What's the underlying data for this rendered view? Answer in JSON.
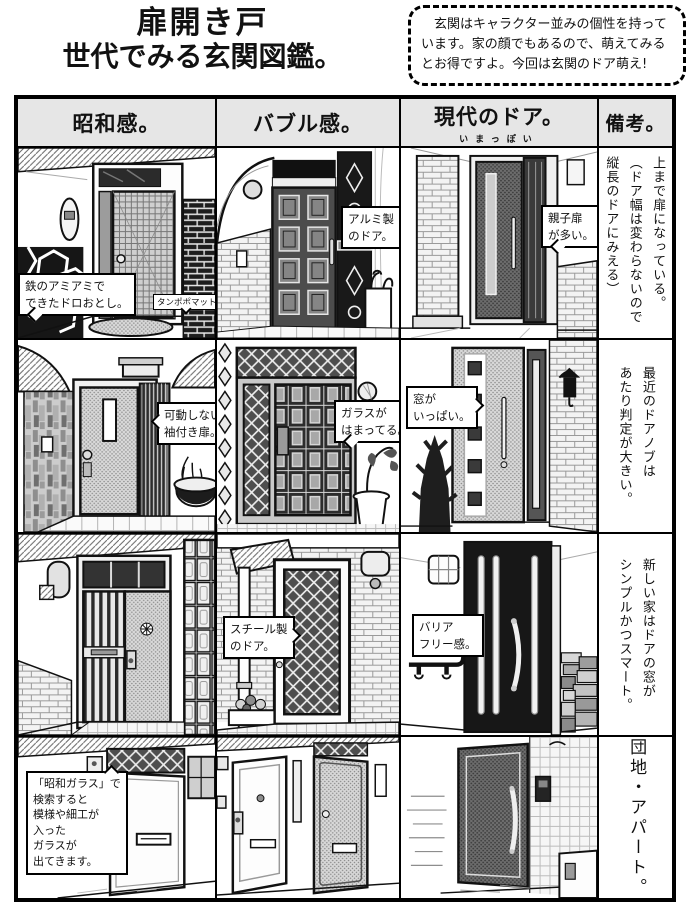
{
  "page": {
    "title_line1": "扉開き戸",
    "title_line2": "世代でみる玄関図鑑。",
    "intro": "　玄関はキャラクター並みの個性を持っています。家の顔でもあるので、萌えてみるとお得ですよ。今回は玄関のドア萌え!"
  },
  "table": {
    "headers": {
      "showa": "昭和感。",
      "bubble": "バブル感。",
      "modern": "現代のドア。",
      "modern_furigana": "いまっぽい",
      "note": "備考。"
    },
    "rows": [
      {
        "showa_callout": [
          "鉄のアミアミで",
          "できたドロおとし。"
        ],
        "showa_tag": [
          "タンポポマット"
        ],
        "bubble_callout": [
          "アルミ製",
          "のドア。"
        ],
        "modern_callout": [
          "親子扉",
          "が多い。"
        ],
        "note": [
          "今どきの玄関は上の小窓がなく、",
          "上まで扉になっている。",
          "（ドア幅は変わらないので",
          "縦長のドアにみえる）"
        ]
      },
      {
        "showa_callout": [
          "可動しない",
          "袖付き扉。"
        ],
        "bubble_callout": [
          "ガラスが",
          "はまってる。"
        ],
        "modern_callout": [
          "窓が",
          "いっぱい。"
        ],
        "note": [
          "最近のドアノブは",
          "あたり判定が大きい。"
        ]
      },
      {
        "bubble_callout": [
          "スチール製",
          "のドア。"
        ],
        "modern_callout": [
          "バリア",
          "フリー感。"
        ],
        "note": [
          "新しい家はドアの窓が",
          "シンプルかつスマート。"
        ]
      },
      {
        "showa_callout": [
          "「昭和ガラス」で",
          "検索すると",
          "模様や細工が",
          "入った",
          "ガラスが",
          "出てきます。"
        ],
        "note": [
          "団地・アパート。"
        ]
      }
    ]
  }
}
